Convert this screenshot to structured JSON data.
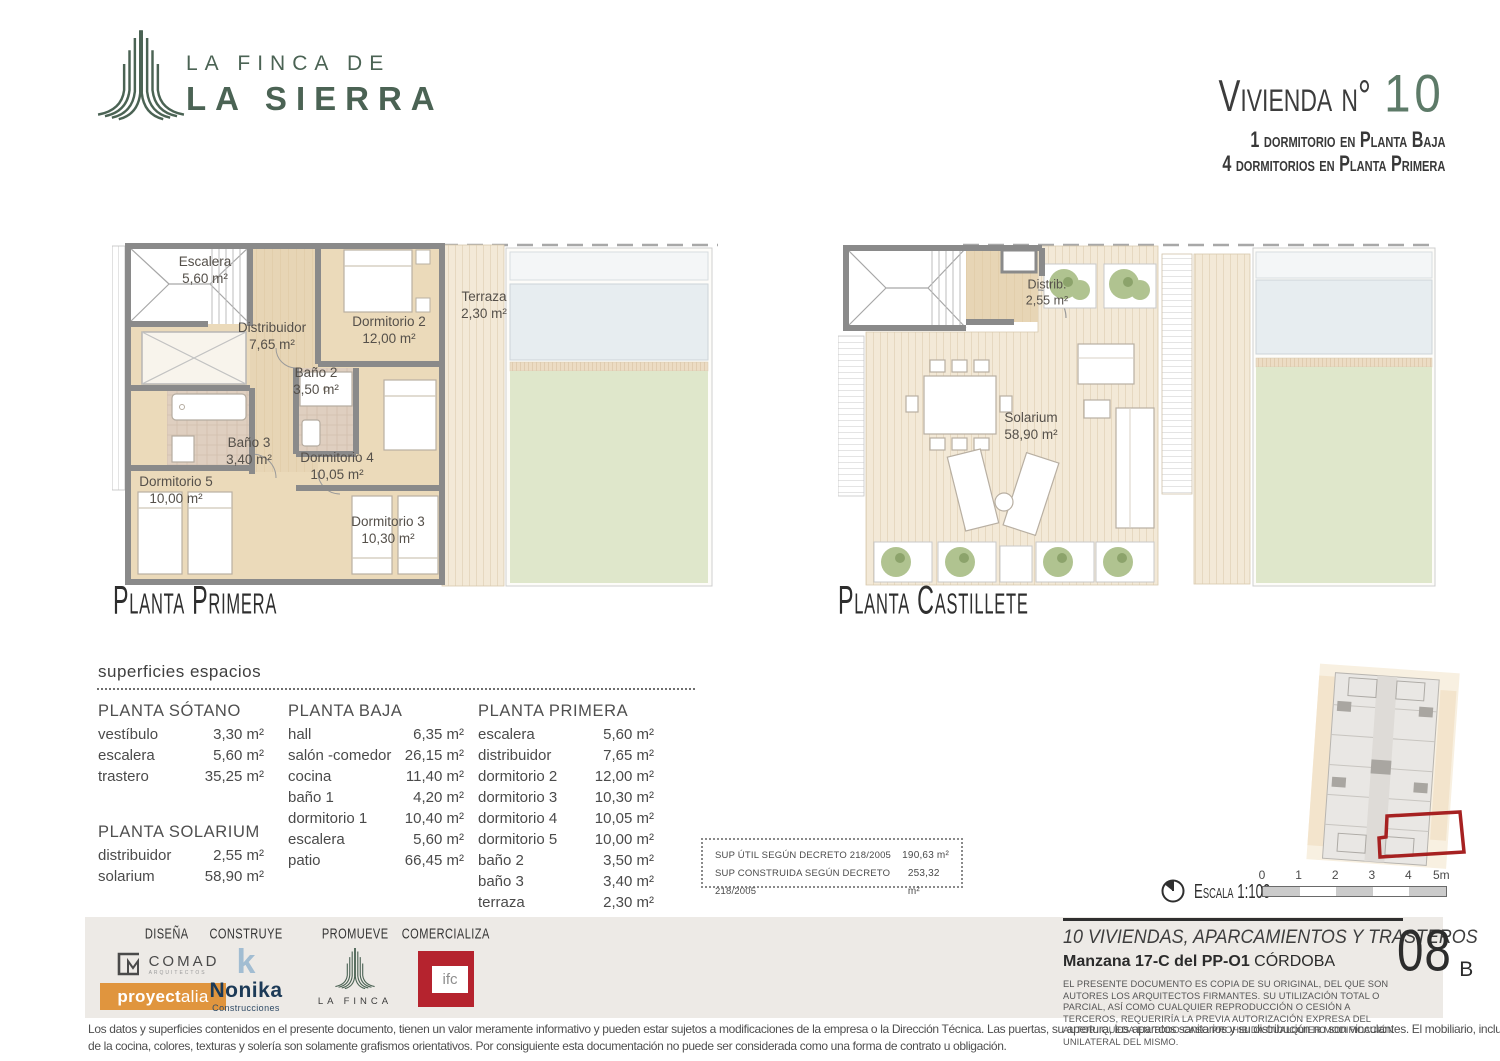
{
  "brand": {
    "logo_line1": "LA FINCA DE",
    "logo_line2": "LA SIERRA",
    "green": "#4b6354"
  },
  "header": {
    "title_label": "Vivienda n°",
    "title_number": "10",
    "subtitle1": "1 dormitorio en Planta Baja",
    "subtitle2": "4 dormitorios en Planta Primera"
  },
  "plans": {
    "left": {
      "caption": "Planta Primera",
      "rooms": [
        {
          "name": "Escalera",
          "area": "5,60 m²"
        },
        {
          "name": "Distribuidor",
          "area": "7,65 m²"
        },
        {
          "name": "Dormitorio 2",
          "area": "12,00 m²"
        },
        {
          "name": "Baño 2",
          "area": "3,50 m²"
        },
        {
          "name": "Baño 3",
          "area": "3,40 m²"
        },
        {
          "name": "Dormitorio 5",
          "area": "10,00 m²"
        },
        {
          "name": "Dormitorio 4",
          "area": "10,05 m²"
        },
        {
          "name": "Dormitorio 3",
          "area": "10,30 m²"
        },
        {
          "name": "Terraza",
          "area": "2,30 m²"
        }
      ]
    },
    "right": {
      "caption": "Planta Castillete",
      "rooms": [
        {
          "name": "Distrib.",
          "area": "2,55 m²"
        },
        {
          "name": "Solarium",
          "area": "58,90 m²"
        }
      ]
    }
  },
  "surfaces": {
    "heading": "superficies espacios",
    "columns": [
      {
        "title": "PLANTA SÓTANO",
        "rows": [
          {
            "label": "vestíbulo",
            "value": "3,30 m²"
          },
          {
            "label": "escalera",
            "value": "5,60 m²"
          },
          {
            "label": "trastero",
            "value": "35,25 m²"
          }
        ]
      },
      {
        "title": "PLANTA SOLARIUM",
        "rows": [
          {
            "label": "distribuidor",
            "value": "2,55 m²"
          },
          {
            "label": "solarium",
            "value": "58,90 m²"
          }
        ]
      },
      {
        "title": "PLANTA BAJA",
        "rows": [
          {
            "label": "hall",
            "value": "6,35 m²"
          },
          {
            "label": "salón -comedor",
            "value": "26,15 m²"
          },
          {
            "label": "cocina",
            "value": "11,40 m²"
          },
          {
            "label": "baño 1",
            "value": "4,20 m²"
          },
          {
            "label": "dormitorio 1",
            "value": "10,40 m²"
          },
          {
            "label": "escalera",
            "value": "5,60 m²"
          },
          {
            "label": "patio",
            "value": "66,45 m²"
          }
        ]
      },
      {
        "title": "PLANTA PRIMERA",
        "rows": [
          {
            "label": "escalera",
            "value": "5,60 m²"
          },
          {
            "label": "distribuidor",
            "value": "7,65 m²"
          },
          {
            "label": "dormitorio 2",
            "value": "12,00 m²"
          },
          {
            "label": "dormitorio 3",
            "value": "10,30 m²"
          },
          {
            "label": "dormitorio 4",
            "value": "10,05 m²"
          },
          {
            "label": "dormitorio 5",
            "value": "10,00 m²"
          },
          {
            "label": "baño 2",
            "value": "3,50 m²"
          },
          {
            "label": "baño 3",
            "value": "3,40 m²"
          },
          {
            "label": "terraza",
            "value": "2,30 m²"
          }
        ]
      }
    ],
    "summary": [
      {
        "label": "SUP ÚTIL SEGÚN DECRETO 218/2005",
        "value": "190,63 m²"
      },
      {
        "label": "SUP CONSTRUIDA SEGÚN DECRETO 218/2005",
        "value": "253,32 m²"
      }
    ]
  },
  "scale": {
    "label": "Escala 1:100",
    "ticks": [
      "0",
      "1",
      "2",
      "3",
      "4",
      "5m"
    ]
  },
  "footer": {
    "roles": {
      "disena": {
        "label": "DISEÑA",
        "comad": "COMAD",
        "comad_sub": "ARQUITECTOS",
        "proyectalia_bold": "proyect",
        "proyectalia_light": "alia"
      },
      "construye": {
        "label": "CONSTRUYE",
        "icon_letter": "k",
        "name": "Nonika",
        "sub": "Construcciones"
      },
      "promueve": {
        "label": "PROMUEVE",
        "name": "LA FINCA"
      },
      "comercializa": {
        "label": "COMERCIALIZA",
        "name": "ifc"
      }
    },
    "project": {
      "title": "10 VIVIENDAS, APARCAMIENTOS Y TRASTEROS",
      "subtitle_bold": "Manzana 17-C del PP-O1",
      "subtitle_city": "CÓRDOBA",
      "legal": "EL PRESENTE DOCUMENTO ES COPIA DE SU ORIGINAL, DEL QUE SON AUTORES LOS ARQUITECTOS FIRMANTES. SU UTILIZACIÓN TOTAL O PARCIAL, ASÍ COMO CUALQUIER REPRODUCCIÓN O CESIÓN A TERCEROS, REQUERIRÍA LA PREVIA AUTORIZACIÓN EXPRESA DEL AUTOR. QUEDA EN TODO CASO PROHIBIDA CUALQUIER MODIFICACIÓN UNILATERAL DEL MISMO.",
      "sheet_number": "08",
      "sheet_letter": "B"
    },
    "disclaimer_line1": "Los datos y superficies contenidos en el presente documento, tienen un valor meramente informativo y pueden estar sujetos a modificaciones de la empresa o la Dirección Técnica. Las puertas, su apertura, los aparatos sanitarios y su distribución no son vinculantes. El mobiliario, incluido el",
    "disclaimer_line2": "de la cocina, colores, texturas y solería son solamente grafismos orientativos. Por consiguiente esta documentación no puede ser considerada como una forma de contrato u obligación."
  },
  "colors": {
    "brand_green": "#4b6354",
    "proyectalia_orange": "#e0953e",
    "nonika_navy": "#1c3a57",
    "ifc_red": "#b5232e",
    "unit_highlight_red": "#a62121"
  }
}
